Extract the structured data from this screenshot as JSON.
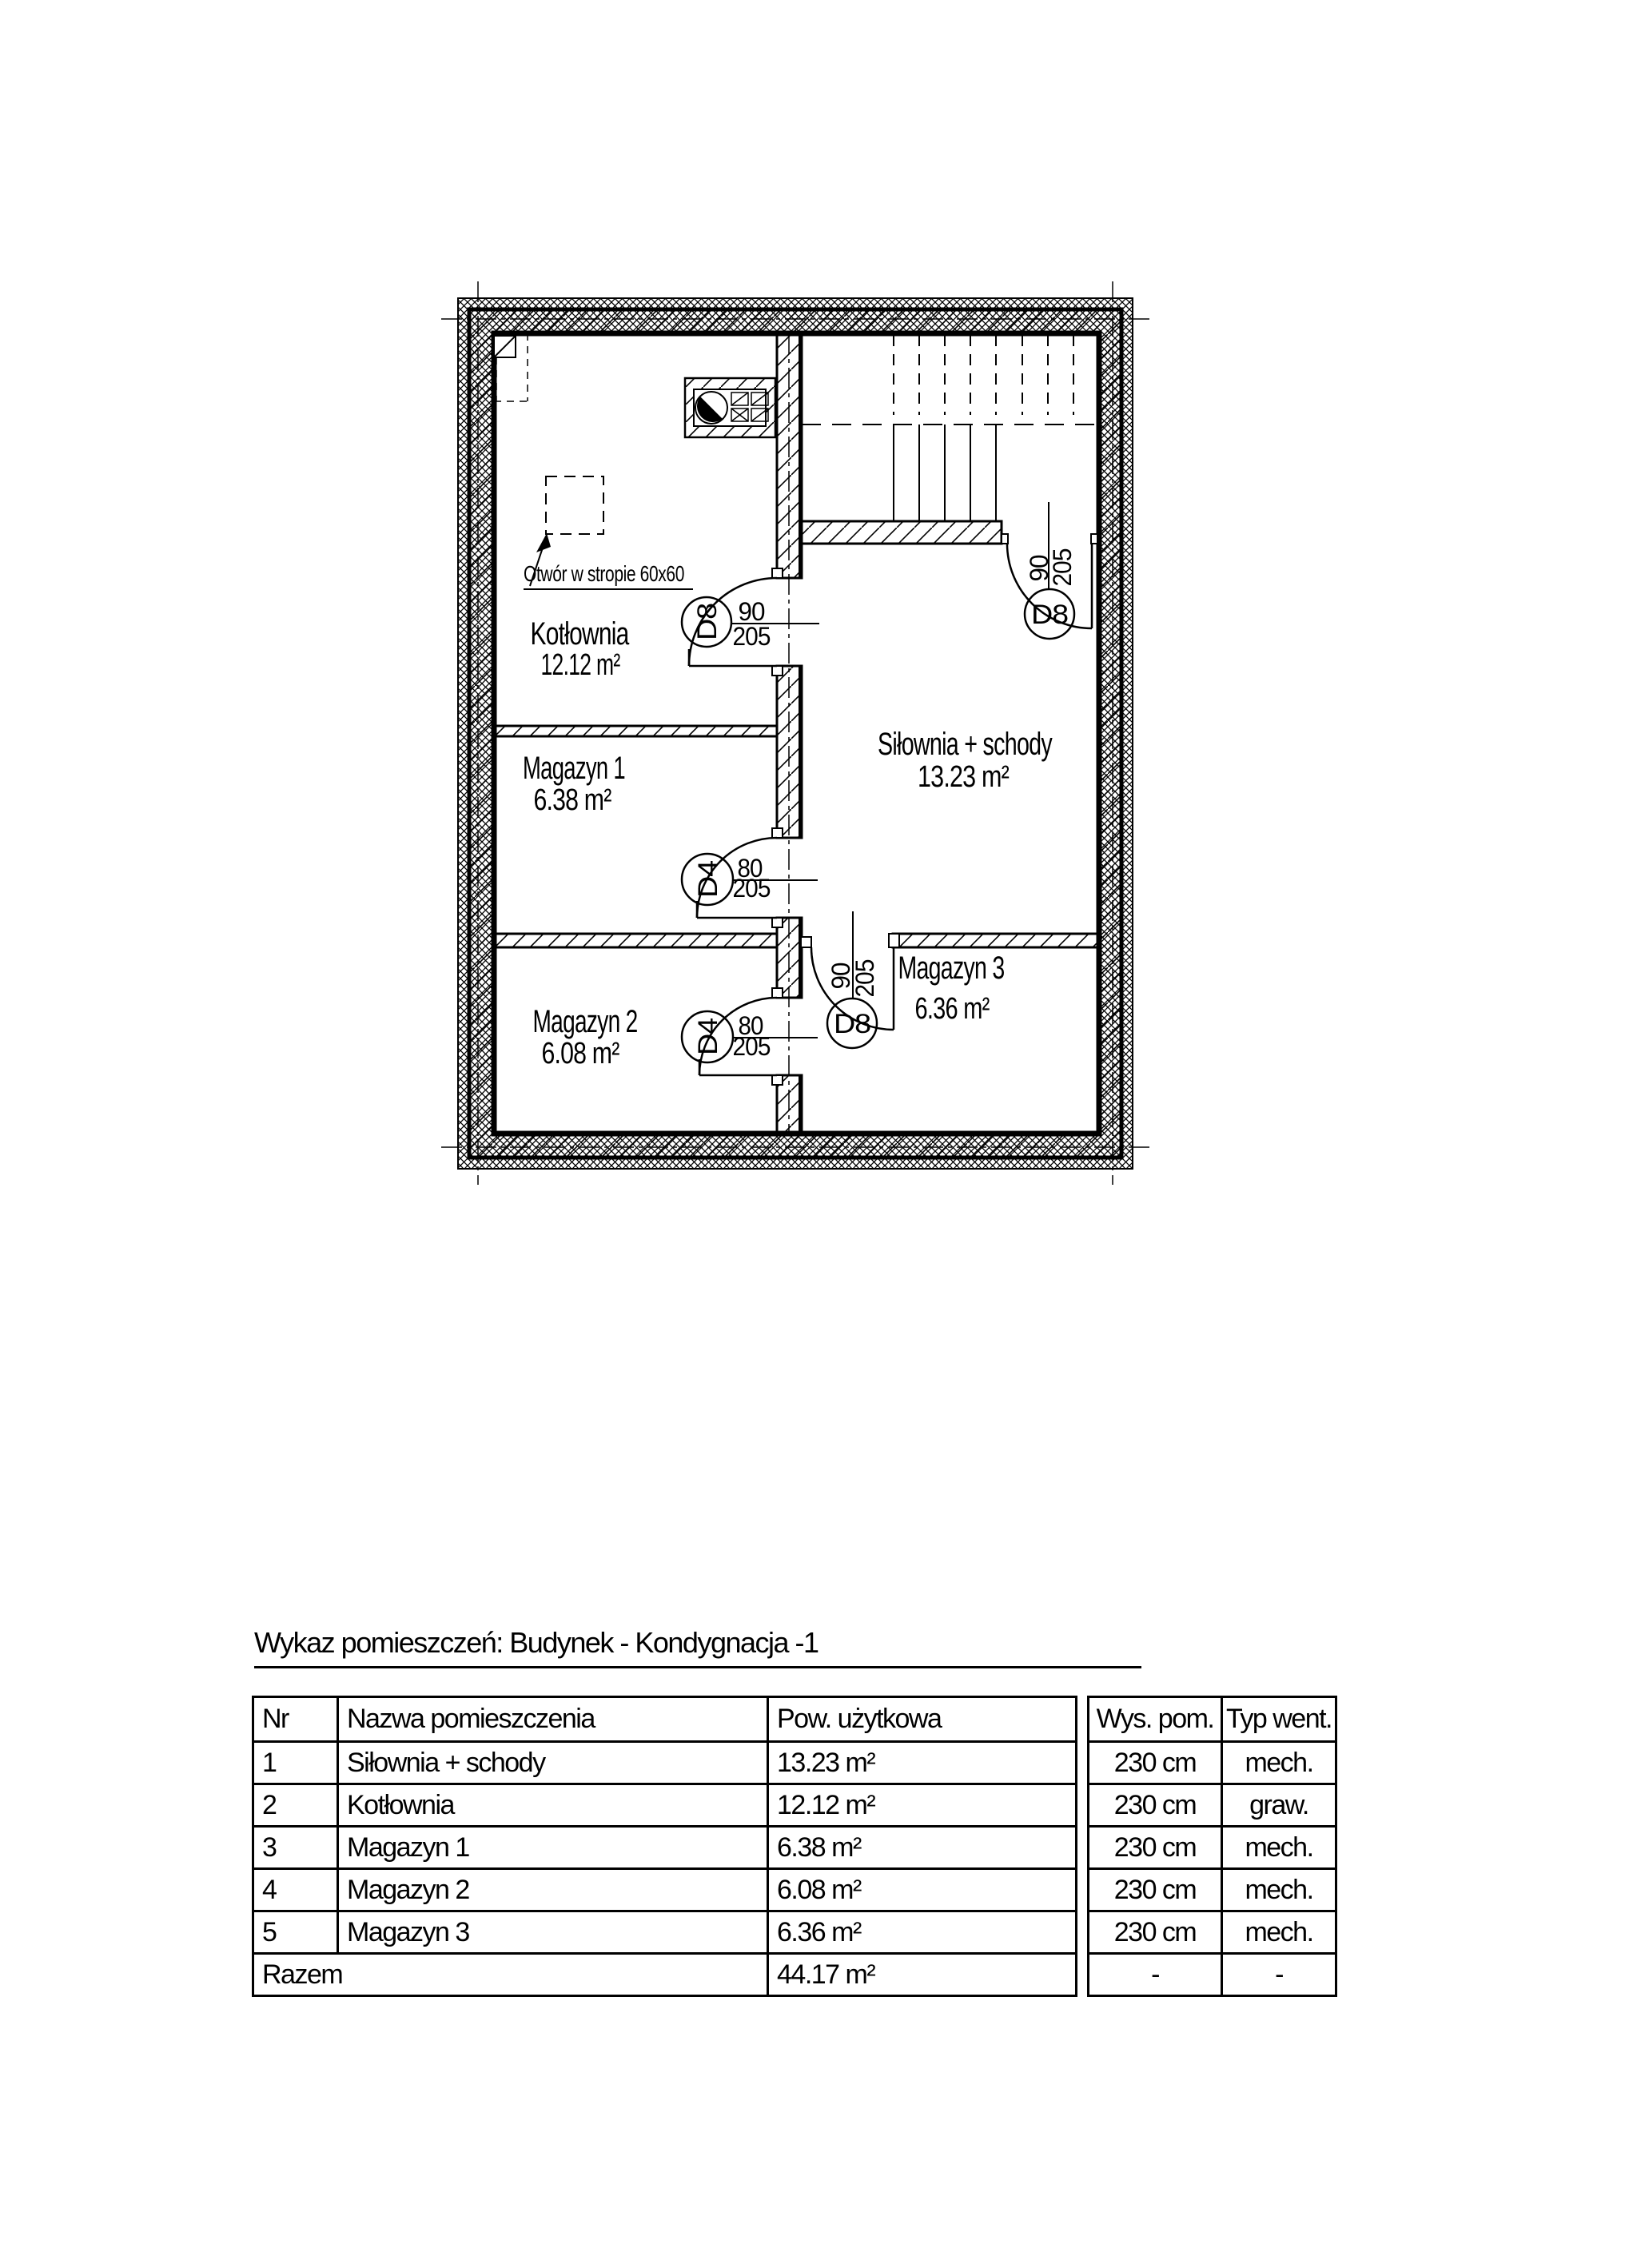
{
  "colors": {
    "ink": "#000000",
    "paper": "#ffffff"
  },
  "plan": {
    "annotation_label": "Otwór w stropie 60x60",
    "rooms": [
      {
        "name": "Kotłownia",
        "area": "12.12 m²"
      },
      {
        "name": "Magazyn 1",
        "area": "6.38 m²"
      },
      {
        "name": "Magazyn 2",
        "area": "6.08 m²"
      },
      {
        "name": "Siłownia + schody",
        "area": "13.23 m²"
      },
      {
        "name": "Magazyn 3",
        "area": "6.36 m²"
      }
    ],
    "doors": [
      {
        "tag": "D8",
        "w": "90",
        "h": "205"
      },
      {
        "tag": "D4",
        "w": "80",
        "h": "205"
      },
      {
        "tag": "D4",
        "w": "80",
        "h": "205"
      },
      {
        "tag": "D8",
        "w": "90",
        "h": "205"
      },
      {
        "tag": "D8",
        "w": "90",
        "h": "205"
      }
    ]
  },
  "schedule": {
    "title": "Wykaz pomieszczeń: Budynek - Kondygnacja -1",
    "main": {
      "headers": [
        "Nr",
        "Nazwa pomieszczenia",
        "Pow. użytkowa"
      ],
      "rows": [
        [
          "1",
          "Siłownia + schody",
          "13.23 m²"
        ],
        [
          "2",
          "Kotłownia",
          "12.12 m²"
        ],
        [
          "3",
          "Magazyn 1",
          "6.38 m²"
        ],
        [
          "4",
          "Magazyn 2",
          "6.08 m²"
        ],
        [
          "5",
          "Magazyn 3",
          "6.36 m²"
        ]
      ],
      "total_label": "Razem",
      "total_area": "44.17 m²"
    },
    "side": {
      "headers": [
        "Wys. pom.",
        "Typ went."
      ],
      "rows": [
        [
          "230 cm",
          "mech."
        ],
        [
          "230 cm",
          "graw."
        ],
        [
          "230 cm",
          "mech."
        ],
        [
          "230 cm",
          "mech."
        ],
        [
          "230 cm",
          "mech."
        ]
      ],
      "total": [
        "-",
        "-"
      ]
    }
  }
}
